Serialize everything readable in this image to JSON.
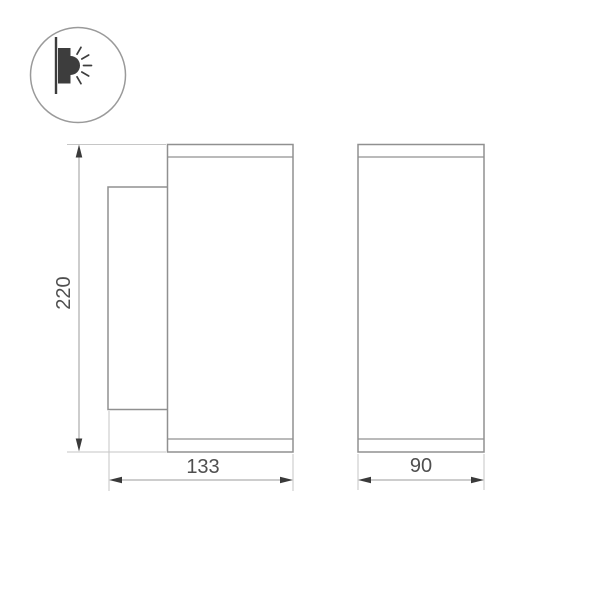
{
  "page": {
    "background": "#ffffff"
  },
  "icon": {
    "name": "wall-light-icon",
    "meaning": "wall-mounted light emitting sideways"
  },
  "drawing": {
    "dimension_labels": {
      "height": "220",
      "width": "133",
      "depth": "90"
    }
  },
  "colors": {
    "outline": "#909090",
    "dimension_line": "#9b9b9b",
    "extension_line": "#c6c6c6",
    "arrow": "#3a3a3a",
    "text": "#4f4f4f",
    "icon_dark": "#3d3d3d",
    "icon_circle": "#9a9a9a"
  }
}
